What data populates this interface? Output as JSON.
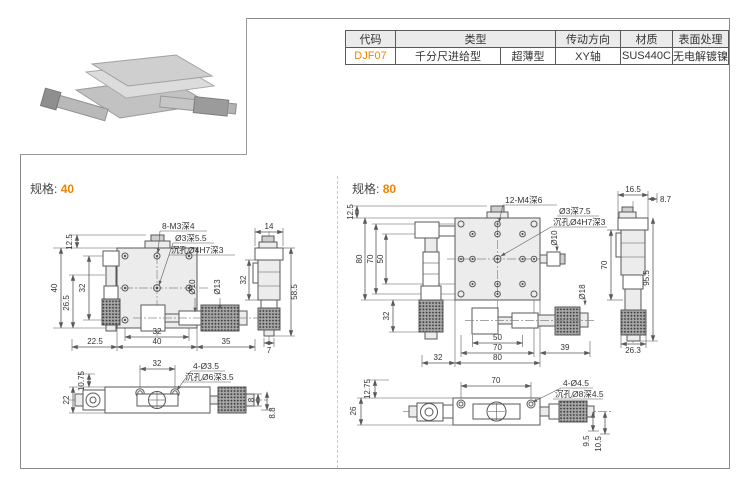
{
  "page": {
    "spec_label": "规格:",
    "colors": {
      "accent": "#f08300",
      "line": "#58595b",
      "table_header_bg": "#ebebeb"
    }
  },
  "product_table": {
    "headers": {
      "code": "代码",
      "type": "类型",
      "direction": "传动方向",
      "material": "材质",
      "surface": "表面处理"
    },
    "row": {
      "code": "DJF07",
      "type_feed": "千分尺进给型",
      "type_profile": "超薄型",
      "direction": "XY轴",
      "material": "SUS440C",
      "surface": "无电解镀镍"
    }
  },
  "spec40": {
    "size": "40",
    "top": {
      "callout_holes": "8-M3深4",
      "callout_center1": "Ø3深5.5",
      "callout_center2": "沉孔Ø4H7深3",
      "dim_knob": "12.5",
      "dim_height": "40",
      "dim_pitch_v": "32",
      "dim_mic_left": "26.5",
      "dim_offset": "22.5",
      "dim_pitch_h": "32",
      "dim_width": "40",
      "dim_mic_right": "35",
      "dim_dia_spindle": "Ø10",
      "dim_dia_sleeve": "Ø13"
    },
    "side": {
      "dim_top": "14",
      "dim_pitch": "32",
      "dim_height": "58.5",
      "dim_bottom": "7"
    },
    "bottom": {
      "dim_offset_v": "10.75",
      "dim_body": "22",
      "dim_pitch": "32",
      "callout1": "4-Ø3.5",
      "callout2": "沉孔Ø6深3.5",
      "dim_tip1": "8",
      "dim_tip2": "8.8"
    }
  },
  "spec80": {
    "size": "80",
    "top": {
      "callout_holes": "12-M4深6",
      "callout_center1": "Ø3深7.5",
      "callout_center2": "沉孔Ø4H7深3",
      "dim_knob": "12.5",
      "dim_height": "80",
      "dim_pitch_outer_v": "70",
      "dim_pitch_inner_v": "50",
      "dim_mic_left_v": "32",
      "dim_dia_knob": "Ø10",
      "dim_dia_knurl": "Ø18",
      "dim_pitch_inner_h": "50",
      "dim_pitch_outer_h": "70",
      "dim_width": "80",
      "dim_offset": "32",
      "dim_mic_right": "39"
    },
    "side": {
      "dim_top": "16.5",
      "dim_top2": "8.7",
      "dim_pitch": "70",
      "dim_height": "95.5",
      "dim_bottom": "26.3"
    },
    "bottom": {
      "dim_offset_v": "12.75",
      "dim_body": "26",
      "dim_pitch": "70",
      "callout1": "4-Ø4.5",
      "callout2": "沉孔Ø8深4.5",
      "dim_tip1": "9.5",
      "dim_tip2": "10.5"
    }
  }
}
